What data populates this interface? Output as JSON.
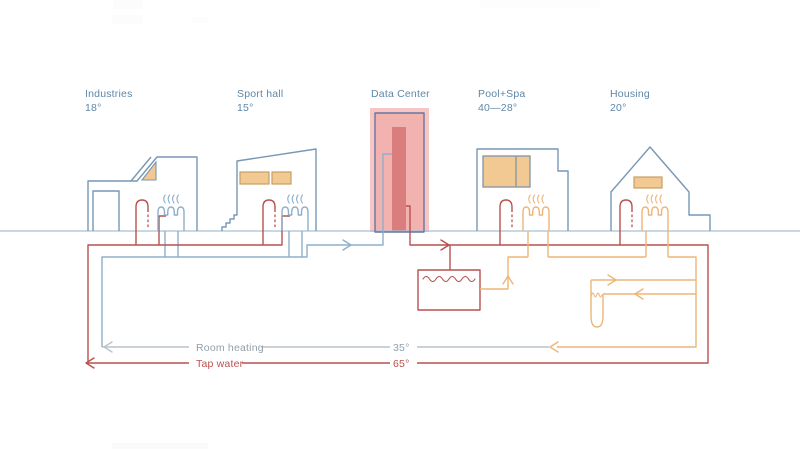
{
  "buildings": [
    {
      "name": "Industries",
      "temp": "18°"
    },
    {
      "name": "Sport hall",
      "temp": "15°"
    },
    {
      "name": "Data Center",
      "temp": ""
    },
    {
      "name": "Pool+Spa",
      "temp": "40—28°"
    },
    {
      "name": "Housing",
      "temp": "20°"
    }
  ],
  "lines": {
    "room_heating": {
      "label": "Room heating",
      "temp": "35°"
    },
    "tap_water": {
      "label": "Tap water",
      "temp": "65°"
    }
  },
  "icons": {
    "tap": "tap-icon",
    "radiator": "radiator-icon",
    "heat_waves": "heat-waves-icon",
    "heat_exchanger": "heat-exchanger-icon",
    "ground_loop": "ground-loop-icon",
    "server_rack": "server-rack-bar"
  },
  "colors": {
    "building_blue": "#7797b5",
    "ground_blue": "#a8c1d5",
    "label_blue": "#5d87a8",
    "pipe_blue": "#8fafc9",
    "gray_line": "#b9c3ca",
    "gray_text": "#93a0aa",
    "red": "#b8514e",
    "orange": "#edb678",
    "tan": "#f2c893",
    "window_stroke": "#c79e63",
    "pool_stroke": "#8195a4",
    "dc_outline": "#64789e",
    "pink_glow": "#f6c5c4",
    "pink_fill": "#f2b2b0",
    "pink_bar": "#d97e7c"
  }
}
